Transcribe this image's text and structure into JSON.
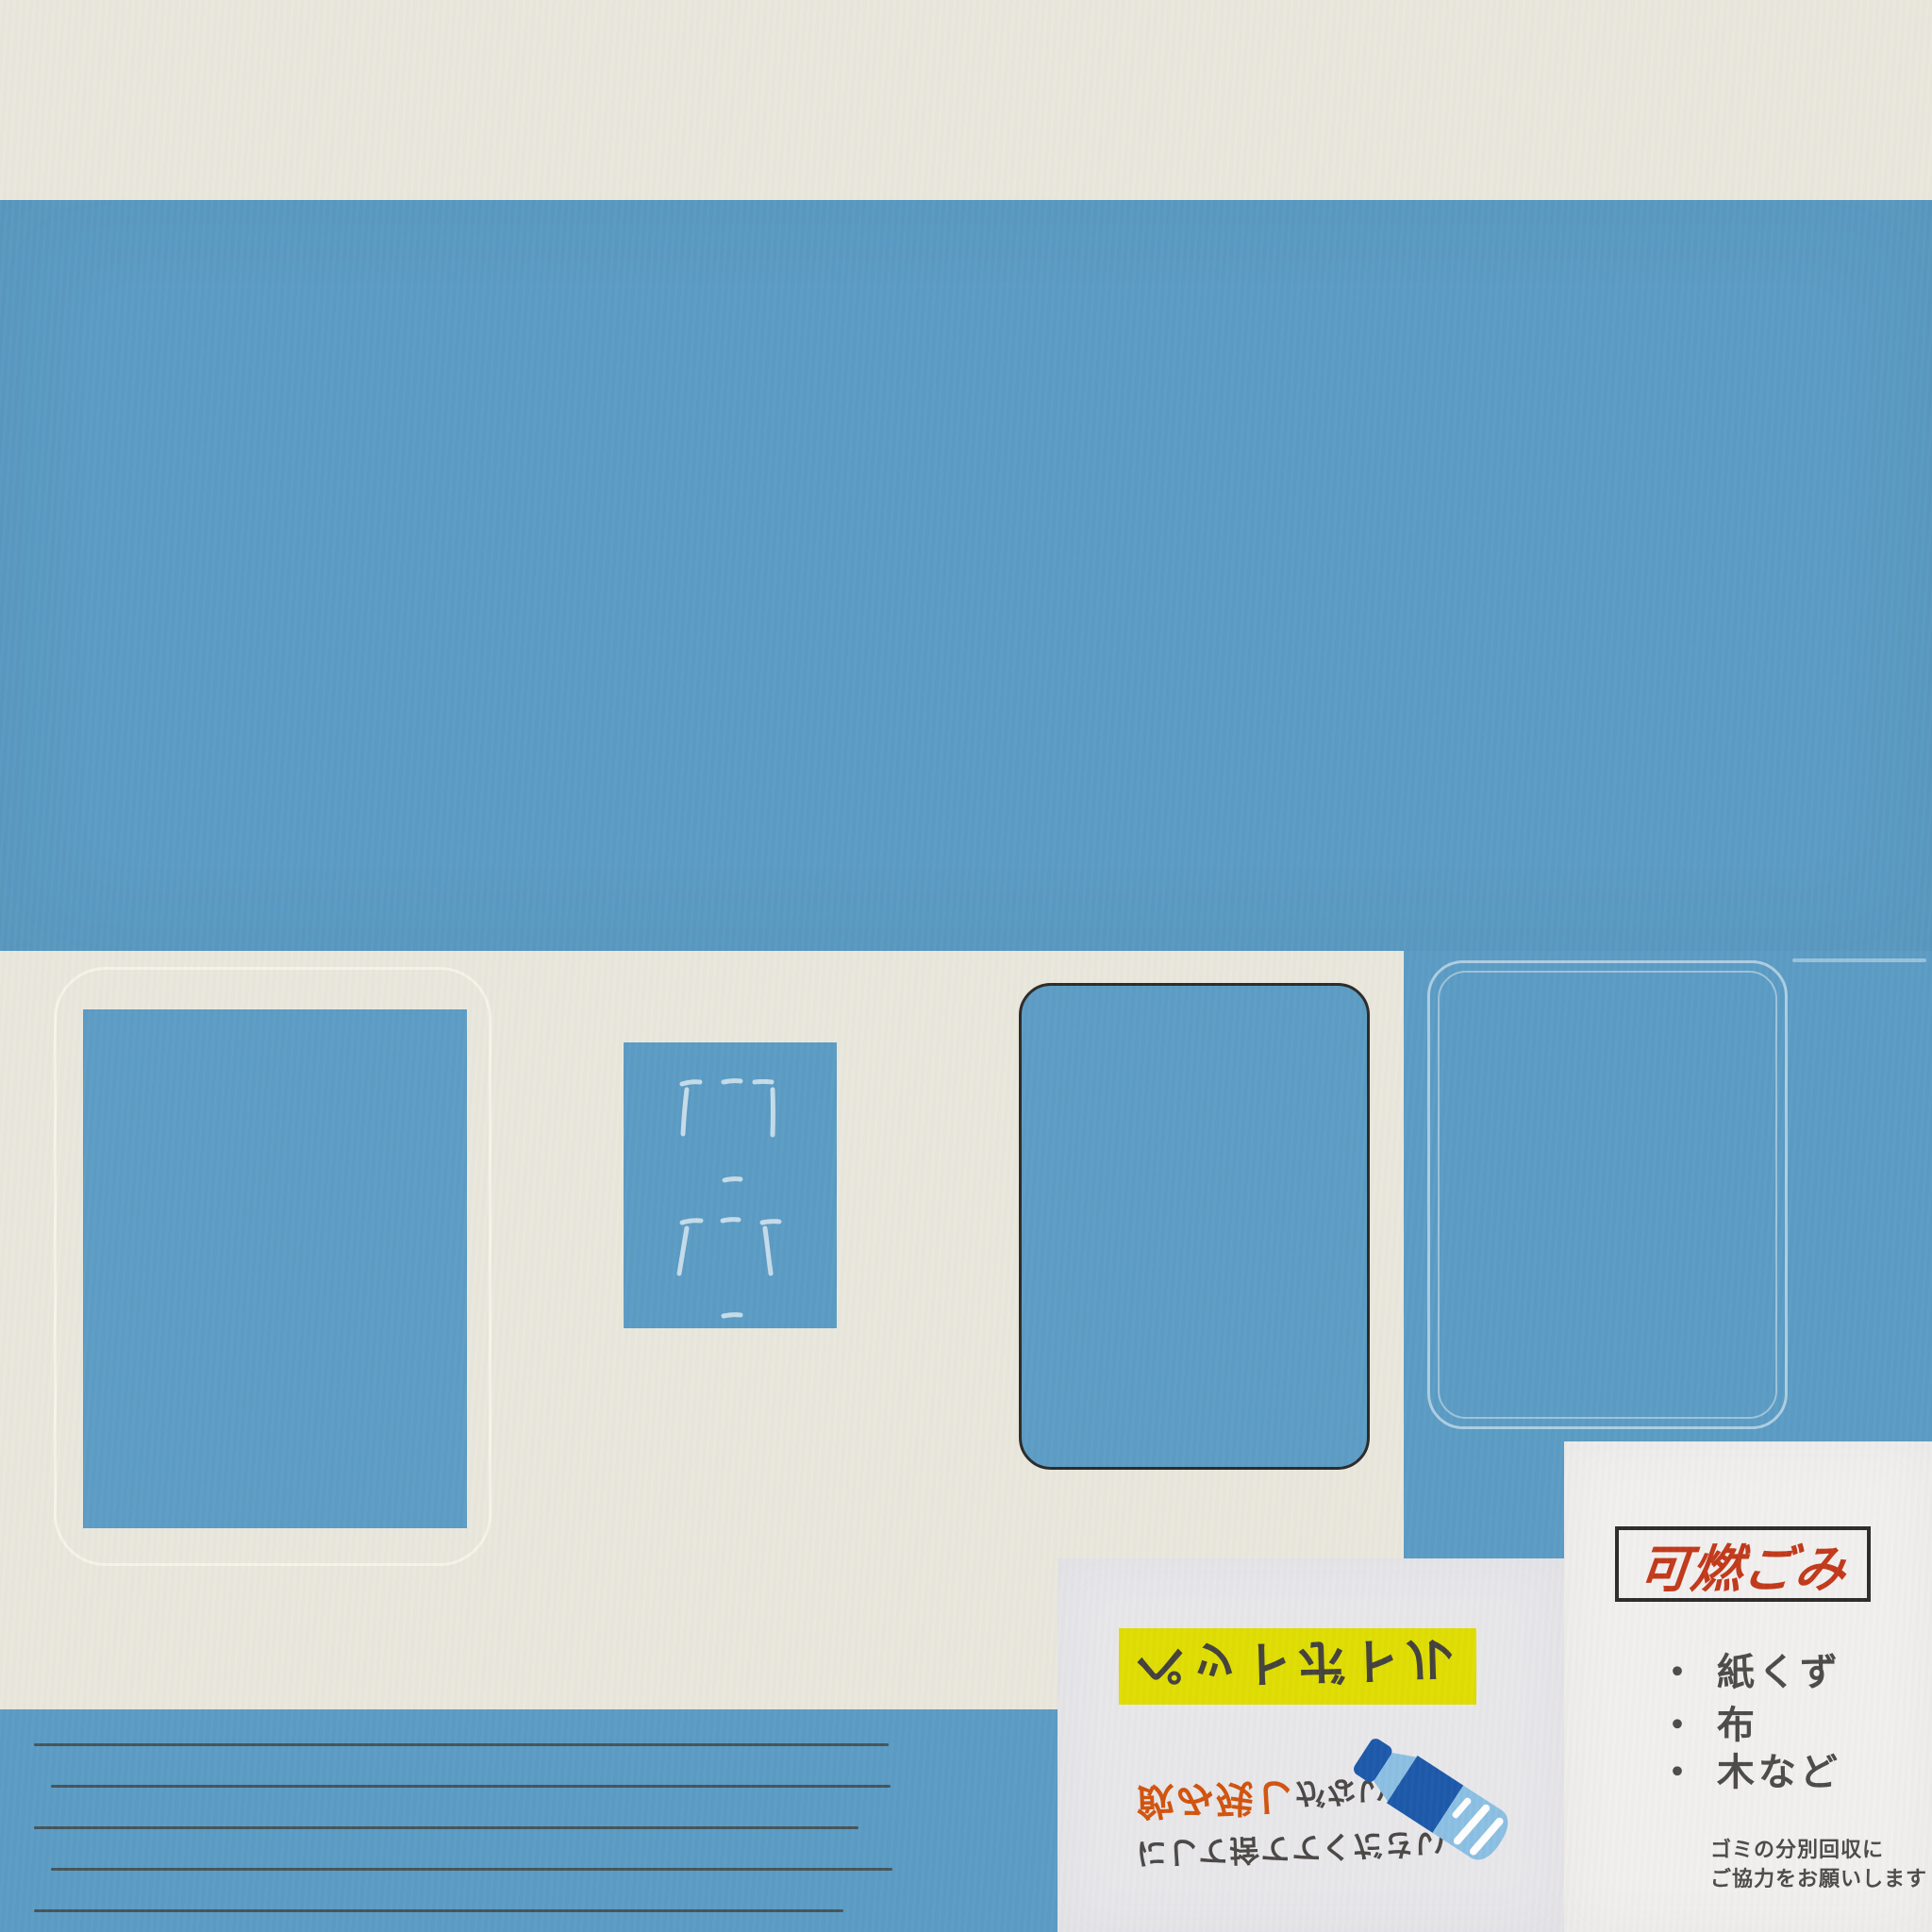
{
  "posters": {
    "pet_bottle": {
      "banner": "ペットボトル",
      "line1_highlight": "飲み残し",
      "line1_rest": "がないよう",
      "line2": "にして捨ててください",
      "orientation_note": "text rendered vertically flipped"
    },
    "burnable": {
      "title": "可燃ごみ",
      "items": [
        "・ 紙くず",
        "・ 布",
        "・ 木など"
      ],
      "footer_line1": "ゴミの分別回収に",
      "footer_line2": "ご協力をお願いします"
    }
  },
  "icons": {
    "bottle": "pet-bottle-icon",
    "doodle": "chalk-doodle-icon"
  },
  "colors": {
    "wall_blue": "#5C9CC4",
    "wall_cream": "#EAE8DD",
    "pet_poster_bg": "#E8E7EA",
    "burnable_poster_bg": "#F2F0EF",
    "banner_yellow": "#E0DD04",
    "title_red": "#C23A1B",
    "highlight_orange": "#D2540E",
    "text_dark": "#4B4846",
    "outline_dark": "#2D2C2A",
    "bottle_light_blue": "#8CC0E3",
    "bottle_dark_blue": "#1E5AAB"
  }
}
